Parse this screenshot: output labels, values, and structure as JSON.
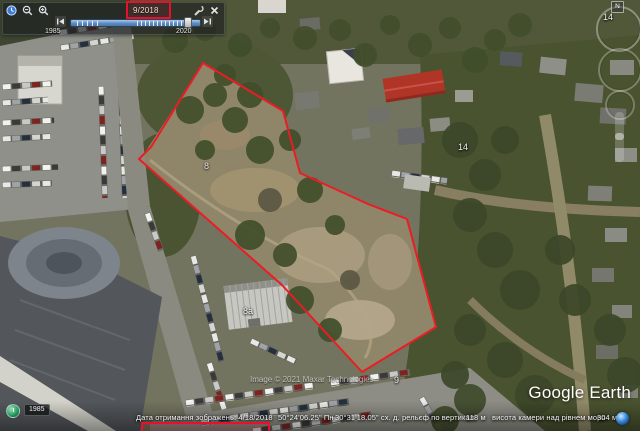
{
  "app": {
    "watermark": "Google Earth",
    "imagery_credit": "Image © 2021 Maxar Technologies"
  },
  "time_slider": {
    "selected_date": "9/2018",
    "start_year": "1985",
    "end_year": "2020"
  },
  "nav": {
    "north_label": "N"
  },
  "map": {
    "red_polygon_points": "203,63 283,111 300,173 368,204 407,219 436,327 362,372 282,285 139,159 151,147",
    "highlight_color": "#ed1c24",
    "labels": {
      "plot_8": "8",
      "plot_14": "14",
      "building_8a": "8а",
      "plot_9": "9",
      "corner_14": "14"
    }
  },
  "status_bar": {
    "history_year_badge": "1985",
    "imagery_date": "Дата отримання зображень: 4/18/2018",
    "latitude": "50°24'06.25\" Пн",
    "longitude": "30°31'18.05\" сх. д.",
    "elevation_label": "рельєф по вертикалі",
    "elevation_value": "118 м",
    "camera_altitude_label": "висота камери над рівнем моря",
    "camera_altitude_value": "304 м"
  }
}
